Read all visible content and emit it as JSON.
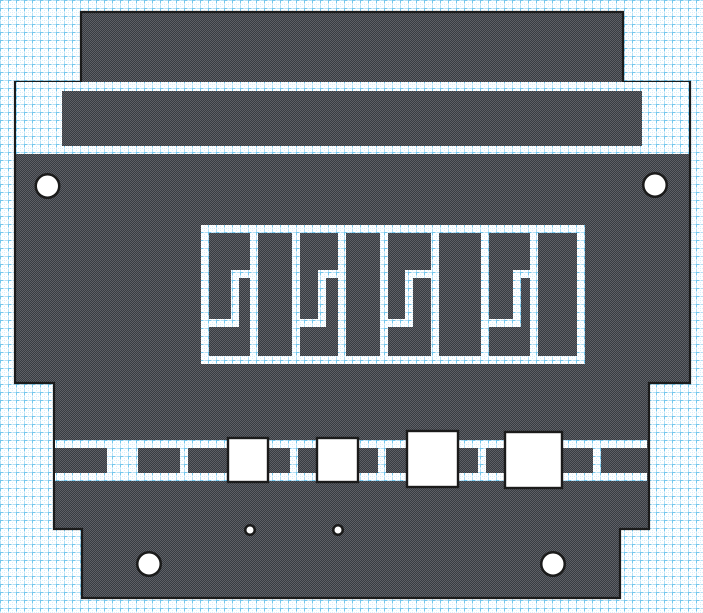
{
  "meta": {
    "title": "flat-pattern-technical-drawing",
    "canvas": {
      "width": 703,
      "height": 613
    }
  },
  "colors": {
    "background": "#ffffff",
    "grid_line": "#b2dff6",
    "grid_accent": "#74c7ec",
    "grid_mid_dot": "#d9effb",
    "part_dark": "#383c42",
    "part_light": "#5e6066",
    "outline": "#1b1b1b",
    "hole_fill": "#ffffff",
    "pad_fill": "#ffffff"
  },
  "grid": {
    "cell": 8
  },
  "part": {
    "outline_stroke_width": 2.2,
    "outline_points": [
      [
        81,
        12
      ],
      [
        623,
        12
      ],
      [
        623,
        82
      ],
      [
        690,
        82
      ],
      [
        690,
        383
      ],
      [
        649,
        383
      ],
      [
        649,
        529
      ],
      [
        620,
        529
      ],
      [
        620,
        598
      ],
      [
        82,
        598
      ],
      [
        82,
        529
      ],
      [
        54,
        529
      ],
      [
        54,
        383
      ],
      [
        15,
        383
      ],
      [
        15,
        82
      ],
      [
        81,
        82
      ]
    ],
    "upper_cutout_rect": [
      16,
      82,
      673,
      72
    ],
    "crossbar_rect": [
      62,
      91,
      580,
      55
    ]
  },
  "middle_pattern": {
    "slots": [
      [
        201,
        225,
        384,
        8
      ],
      [
        201,
        356,
        384,
        8
      ],
      [
        201,
        225,
        8,
        139
      ],
      [
        577,
        225,
        8,
        139
      ],
      [
        250,
        225,
        8,
        139
      ],
      [
        292,
        225,
        8,
        139
      ],
      [
        338,
        225,
        8,
        139
      ],
      [
        380,
        225,
        8,
        139
      ],
      [
        431,
        225,
        8,
        139
      ],
      [
        481,
        225,
        8,
        139
      ],
      [
        530,
        225,
        8,
        139
      ],
      [
        231,
        270,
        27,
        8
      ],
      [
        231,
        270,
        8,
        57
      ],
      [
        201,
        319,
        38,
        8
      ],
      [
        318,
        270,
        28,
        8
      ],
      [
        318,
        270,
        8,
        57
      ],
      [
        292,
        319,
        34,
        8
      ],
      [
        405,
        270,
        34,
        8
      ],
      [
        405,
        270,
        8,
        57
      ],
      [
        380,
        319,
        33,
        8
      ],
      [
        513,
        270,
        25,
        8
      ],
      [
        513,
        270,
        8,
        57
      ],
      [
        481,
        319,
        40,
        8
      ]
    ]
  },
  "band": {
    "slots": [
      [
        55,
        440,
        592,
        8
      ],
      [
        55,
        473,
        592,
        8
      ],
      [
        107,
        440,
        31,
        41
      ],
      [
        180,
        440,
        8,
        41
      ],
      [
        290,
        440,
        8,
        41
      ],
      [
        378,
        440,
        8,
        41
      ],
      [
        478,
        440,
        8,
        41
      ],
      [
        593,
        440,
        8,
        41
      ]
    ]
  },
  "pads": {
    "stroke_width": 2.4,
    "squares": [
      [
        228,
        438,
        40,
        44
      ],
      [
        317,
        438,
        41,
        44
      ],
      [
        407,
        431,
        51,
        56
      ],
      [
        505,
        432,
        57,
        56
      ]
    ]
  },
  "holes": {
    "stroke_width": 2.5,
    "large_radius": 11.75,
    "small_radius": 4.75,
    "large": [
      [
        47.5,
        186
      ],
      [
        655,
        185
      ],
      [
        149,
        564
      ],
      [
        553,
        564
      ]
    ],
    "small": [
      [
        250,
        530
      ],
      [
        338,
        530
      ]
    ]
  }
}
